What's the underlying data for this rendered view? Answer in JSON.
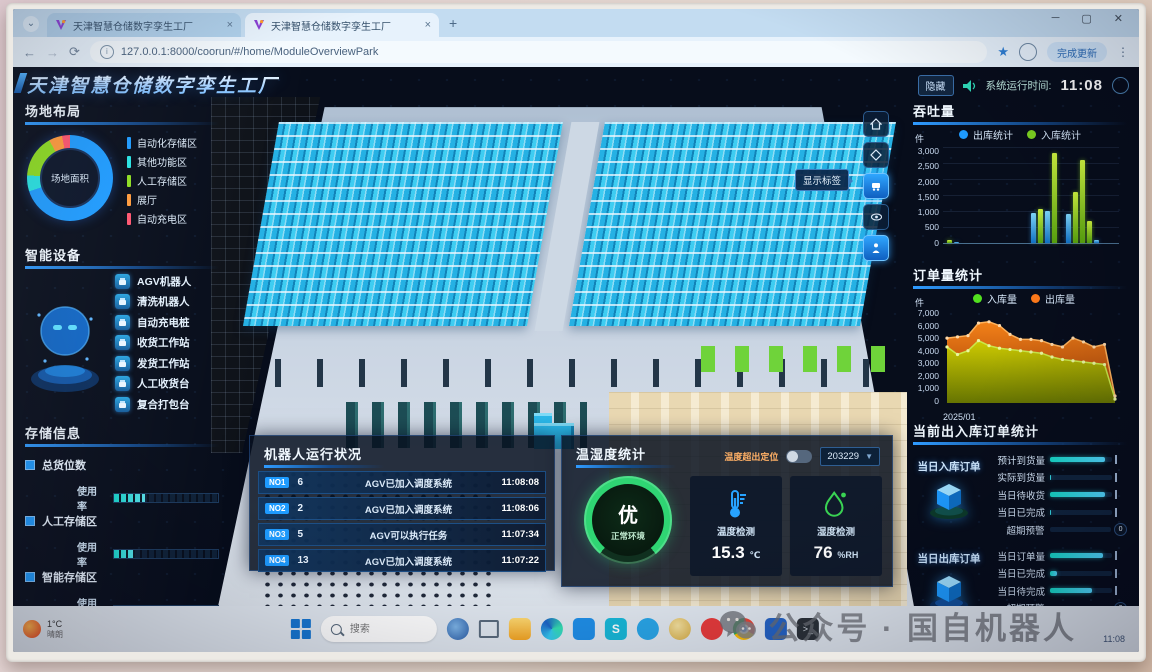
{
  "browser": {
    "tabs": [
      {
        "title": "天津智慧仓储数字孪生工厂"
      },
      {
        "title": "天津智慧仓储数字孪生工厂"
      }
    ],
    "url": "127.0.0.1:8000/coorun/#/home/ModuleOverviewPark",
    "update_button": "完成更新"
  },
  "header": {
    "title": "天津智慧仓储数字孪生工厂",
    "hide_button": "隐藏",
    "runtime_label": "系统运行时间:",
    "clock": "11:08"
  },
  "site_layout": {
    "title": "场地布局",
    "donut_center": "场地面积",
    "segments": [
      {
        "label": "自动化存储区",
        "color": "#1e9bff",
        "value": 70
      },
      {
        "label": "其他功能区",
        "color": "#27e2e2",
        "value": 6
      },
      {
        "label": "人工存储区",
        "color": "#8ddc21",
        "value": 16
      },
      {
        "label": "展厅",
        "color": "#ff9a3c",
        "value": 5
      },
      {
        "label": "自动充电区",
        "color": "#ff5570",
        "value": 3
      }
    ]
  },
  "devices": {
    "title": "智能设备",
    "items": [
      {
        "label": "AGV机器人"
      },
      {
        "label": "清洗机器人"
      },
      {
        "label": "自动充电桩"
      },
      {
        "label": "收货工作站"
      },
      {
        "label": "发货工作站"
      },
      {
        "label": "人工收货台"
      },
      {
        "label": "复合打包台"
      }
    ]
  },
  "storage": {
    "title": "存储信息",
    "usage_label": "使用率",
    "groups": [
      {
        "label": "总货位数",
        "percent": 30
      },
      {
        "label": "人工存储区",
        "percent": 20
      },
      {
        "label": "智能存储区",
        "percent": 55
      }
    ]
  },
  "view_toolbar": {
    "tooltip": "显示标签"
  },
  "chart_data": [
    {
      "type": "bar",
      "title": "吞吐量",
      "ylabel": "件",
      "ylim": [
        0,
        3000
      ],
      "yticks": [
        "3,000",
        "2,500",
        "2,000",
        "1,500",
        "1,000",
        "500",
        "0"
      ],
      "legend": [
        {
          "label": "出库统计",
          "color": "#1e9bff"
        },
        {
          "label": "入库统计",
          "color": "#7ed321"
        }
      ],
      "bars": [
        {
          "x": 2,
          "series": "入库统计",
          "v": 80
        },
        {
          "x": 6,
          "series": "出库统计",
          "v": 40
        },
        {
          "x": 50,
          "series": "出库统计",
          "v": 950
        },
        {
          "x": 54,
          "series": "入库统计",
          "v": 1050
        },
        {
          "x": 58,
          "series": "出库统计",
          "v": 1000
        },
        {
          "x": 62,
          "series": "入库统计",
          "v": 2800
        },
        {
          "x": 70,
          "series": "出库统计",
          "v": 900
        },
        {
          "x": 74,
          "series": "入库统计",
          "v": 1600
        },
        {
          "x": 78,
          "series": "入库统计",
          "v": 2600
        },
        {
          "x": 82,
          "series": "入库统计",
          "v": 700
        },
        {
          "x": 86,
          "series": "出库统计",
          "v": 100
        }
      ]
    },
    {
      "type": "area",
      "title": "订单量统计",
      "ylabel": "件",
      "xlabel": "2025/01",
      "ylim": [
        0,
        7000
      ],
      "yticks": [
        "7,000",
        "6,000",
        "5,000",
        "4,000",
        "3,000",
        "2,000",
        "1,000",
        "0"
      ],
      "legend": [
        {
          "label": "入库量",
          "color": "#52e01f"
        },
        {
          "label": "出库量",
          "color": "#ff7a1a"
        }
      ],
      "series": [
        {
          "name": "出库量",
          "values": [
            5000,
            5100,
            5200,
            6200,
            6300,
            6000,
            5300,
            4900,
            4900,
            4800,
            4500,
            4300,
            5000,
            4700,
            4300,
            4500,
            400
          ]
        },
        {
          "name": "入库量",
          "values": [
            4300,
            3700,
            4000,
            4800,
            4400,
            4200,
            4100,
            4000,
            3900,
            3800,
            3500,
            3300,
            3200,
            3100,
            3000,
            2900,
            150
          ]
        }
      ]
    }
  ],
  "current_orders": {
    "title": "当前出入库订单统计",
    "inbound": {
      "group_label": "当日入库订单",
      "rows": [
        {
          "label": "预计到货量",
          "percent": 88
        },
        {
          "label": "实际到货量",
          "percent": 2
        },
        {
          "label": "当日待收货",
          "percent": 88
        },
        {
          "label": "当日已完成",
          "percent": 2
        },
        {
          "label": "超期预警",
          "percent": 0,
          "value": "0"
        }
      ]
    },
    "outbound": {
      "group_label": "当日出库订单",
      "rows": [
        {
          "label": "当日订单量",
          "percent": 85
        },
        {
          "label": "当日已完成",
          "percent": 12
        },
        {
          "label": "当日待完成",
          "percent": 68
        },
        {
          "label": "超期预警",
          "percent": 0,
          "value": "0"
        }
      ]
    }
  },
  "robot_status": {
    "title": "机器人运行状况",
    "rows": [
      {
        "no": "NO1",
        "count": "6",
        "message": "AGV已加入调度系统",
        "time": "11:08:08"
      },
      {
        "no": "NO2",
        "count": "2",
        "message": "AGV已加入调度系统",
        "time": "11:08:06"
      },
      {
        "no": "NO3",
        "count": "5",
        "message": "AGV可以执行任务",
        "time": "11:07:34"
      },
      {
        "no": "NO4",
        "count": "13",
        "message": "AGV已加入调度系统",
        "time": "11:07:22"
      }
    ]
  },
  "environment": {
    "title": "温湿度统计",
    "locate_label": "温度超出定位",
    "station_select": "203229",
    "grade": "优",
    "grade_sub": "正常环境",
    "temperature": {
      "label": "温度检测",
      "value": "15.3",
      "unit": "℃"
    },
    "humidity": {
      "label": "湿度检测",
      "value": "76",
      "unit": "%RH"
    }
  },
  "taskbar": {
    "weather_temp": "1°C",
    "weather_desc": "晴朗",
    "search_placeholder": "搜索",
    "tray_time": "11:08"
  },
  "watermark": "公众号 · 国自机器人"
}
